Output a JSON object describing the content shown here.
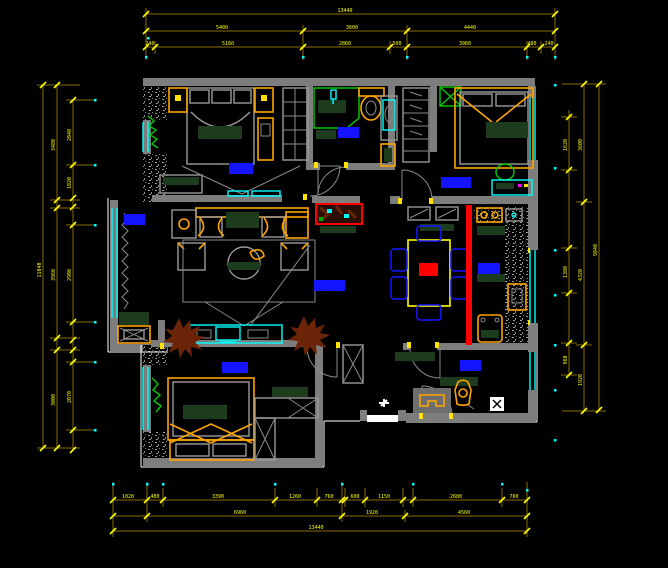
{
  "meta": {
    "drawing_type": "residential-floor-plan",
    "background": "#000000",
    "overall_width_dim": "13440",
    "overall_height_dim": "11040"
  },
  "colors": {
    "wall_gray": "#7d7d7d",
    "dim_line": "#8a6d00",
    "dim_text_yellow": "#ffff00",
    "window_cyan": "#00ffff",
    "furniture_orange": "#ffa500",
    "soft_dark_green": "#1d3b1d",
    "plant_bright_green": "#00cc00",
    "room_label_blue": "#1414ff",
    "divider_red": "#ff0000",
    "plant_brown": "#6b2407",
    "outline_white": "#ffffff"
  },
  "rooms": [
    {
      "id": "master-bedroom",
      "label": "主卧",
      "x": 229,
      "y": 163,
      "w": 24,
      "h": 11
    },
    {
      "id": "bathroom",
      "label": "卫生间",
      "x": 338,
      "y": 127,
      "w": 21,
      "h": 11
    },
    {
      "id": "second-bedroom",
      "label": "次卧",
      "x": 441,
      "y": 177,
      "w": 30,
      "h": 11
    },
    {
      "id": "living-room",
      "label": "客厅",
      "x": 124,
      "y": 214,
      "w": 21,
      "h": 11
    },
    {
      "id": "dining-room",
      "label": "餐厅",
      "x": 314,
      "y": 280,
      "w": 31,
      "h": 11
    },
    {
      "id": "kitchen",
      "label": "厨房",
      "x": 478,
      "y": 263,
      "w": 22,
      "h": 11
    },
    {
      "id": "kids-bedroom",
      "label": "儿童房",
      "x": 222,
      "y": 362,
      "w": 26,
      "h": 11
    },
    {
      "id": "entry",
      "label": "玄关",
      "x": 460,
      "y": 360,
      "w": 21,
      "h": 11
    }
  ],
  "dim_texts": [
    {
      "v": "13440",
      "x": 345,
      "y": 12,
      "r": 0
    },
    {
      "v": "5400",
      "x": 222,
      "y": 29,
      "r": 0
    },
    {
      "v": "3600",
      "x": 352,
      "y": 29,
      "r": 0
    },
    {
      "v": "4440",
      "x": 470,
      "y": 29,
      "r": 0
    },
    {
      "v": "240",
      "x": 150,
      "y": 45,
      "r": 0
    },
    {
      "v": "5160",
      "x": 228,
      "y": 45,
      "r": 0
    },
    {
      "v": "2860",
      "x": 345,
      "y": 45,
      "r": 0
    },
    {
      "v": "500",
      "x": 397,
      "y": 45,
      "r": 0
    },
    {
      "v": "3960",
      "x": 465,
      "y": 45,
      "r": 0
    },
    {
      "v": "480",
      "x": 532,
      "y": 45,
      "r": 0
    },
    {
      "v": "240",
      "x": 549,
      "y": 45,
      "r": 0
    },
    {
      "v": "1020",
      "x": 128,
      "y": 498,
      "r": 0
    },
    {
      "v": "480",
      "x": 155,
      "y": 498,
      "r": 0
    },
    {
      "v": "3390",
      "x": 218,
      "y": 498,
      "r": 0
    },
    {
      "v": "1260",
      "x": 295,
      "y": 498,
      "r": 0
    },
    {
      "v": "760",
      "x": 329,
      "y": 498,
      "r": 0
    },
    {
      "v": "600",
      "x": 355,
      "y": 498,
      "r": 0
    },
    {
      "v": "1150",
      "x": 384,
      "y": 498,
      "r": 0
    },
    {
      "v": "2680",
      "x": 456,
      "y": 498,
      "r": 0
    },
    {
      "v": "760",
      "x": 514,
      "y": 498,
      "r": 0
    },
    {
      "v": "6960",
      "x": 240,
      "y": 514,
      "r": 0
    },
    {
      "v": "1920",
      "x": 372,
      "y": 514,
      "r": 0
    },
    {
      "v": "4560",
      "x": 464,
      "y": 514,
      "r": 0
    },
    {
      "v": "13440",
      "x": 316,
      "y": 529,
      "r": 0
    },
    {
      "v": "11040",
      "x": 41,
      "y": 270,
      "r": -90
    },
    {
      "v": "3480",
      "x": 55,
      "y": 145,
      "r": -90
    },
    {
      "v": "3960",
      "x": 55,
      "y": 275,
      "r": -90
    },
    {
      "v": "3000",
      "x": 55,
      "y": 400,
      "r": -90
    },
    {
      "v": "2040",
      "x": 71,
      "y": 135,
      "r": -90
    },
    {
      "v": "1020",
      "x": 71,
      "y": 183,
      "r": -90
    },
    {
      "v": "2900",
      "x": 71,
      "y": 275,
      "r": -90
    },
    {
      "v": "2070",
      "x": 71,
      "y": 397,
      "r": -90
    },
    {
      "v": "9840",
      "x": 597,
      "y": 250,
      "r": -90
    },
    {
      "v": "3600",
      "x": 582,
      "y": 145,
      "r": -90
    },
    {
      "v": "4320",
      "x": 582,
      "y": 275,
      "r": -90
    },
    {
      "v": "1920",
      "x": 582,
      "y": 380,
      "r": -90
    },
    {
      "v": "1620",
      "x": 567,
      "y": 145,
      "r": -90
    },
    {
      "v": "1380",
      "x": 567,
      "y": 272,
      "r": -90
    },
    {
      "v": "960",
      "x": 567,
      "y": 360,
      "r": -90
    }
  ]
}
